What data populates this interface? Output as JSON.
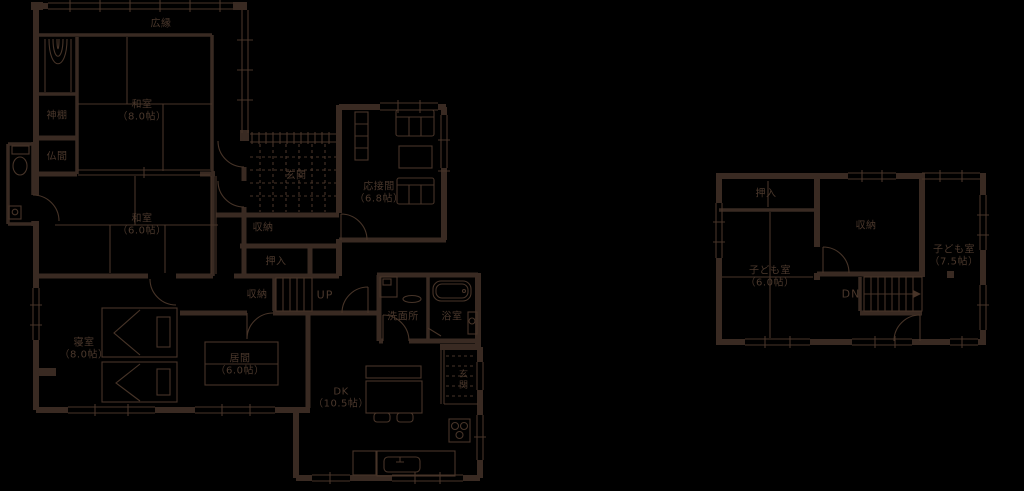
{
  "document_type": "floor-plan",
  "colors": {
    "background": "#000000",
    "wall": "#392a22",
    "line": "#473428",
    "text": "#4b382c"
  },
  "floor1": {
    "rooms": {
      "hiroen": {
        "name": "広縁"
      },
      "washitsu8": {
        "name": "和室",
        "size": "（8.0帖）"
      },
      "kamidana": {
        "name": "神棚"
      },
      "butsuma": {
        "name": "仏間"
      },
      "genkan": {
        "name": "玄関"
      },
      "ousetsuma": {
        "name": "応接間",
        "size": "（6.8帖）"
      },
      "washitsu6": {
        "name": "和室",
        "size": "（6.0帖）"
      },
      "storage_hall": {
        "name": "収納"
      },
      "oshiire": {
        "name": "押入"
      },
      "storage_stairs": {
        "name": "収納"
      },
      "stairs_up": {
        "name": "UP"
      },
      "senmenjo": {
        "name": "洗面所"
      },
      "yokushitsu": {
        "name": "浴室"
      },
      "shinshitsu": {
        "name": "寝室",
        "size": "（8.0帖）"
      },
      "ima": {
        "name": "居間",
        "size": "（6.0帖）"
      },
      "dk": {
        "name": "DK",
        "size": "（10.5帖）"
      },
      "genkan_east": {
        "name": "玄関"
      }
    }
  },
  "floor2": {
    "rooms": {
      "oshiire": {
        "name": "押入"
      },
      "storage": {
        "name": "収納"
      },
      "kodomo_75": {
        "name": "子ども室",
        "size": "（7.5帖）"
      },
      "kodomo_60": {
        "name": "子ども室",
        "size": "（6.0帖）"
      },
      "stairs_dn": {
        "name": "DN"
      }
    }
  }
}
